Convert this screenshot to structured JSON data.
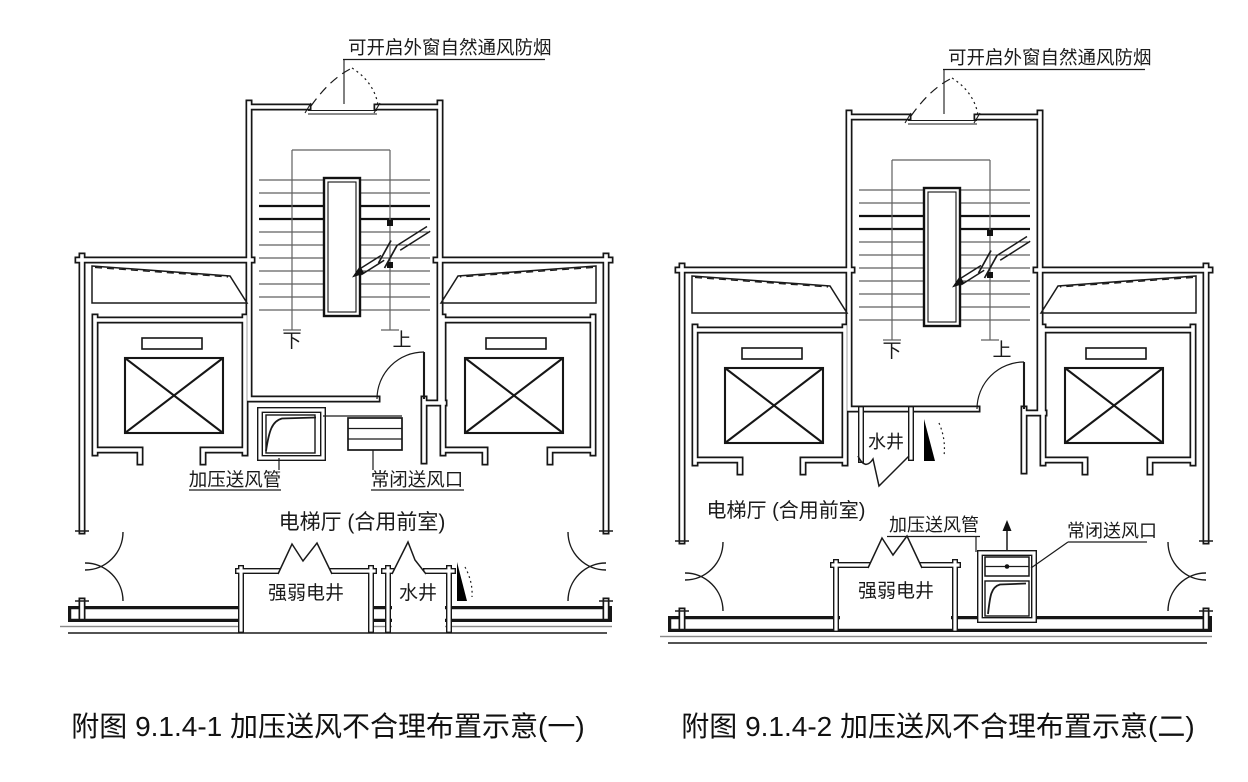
{
  "figure": {
    "window_label": "可开启外窗自然通风防烟",
    "stair_down": "下",
    "stair_up": "上",
    "duct_label": "加压送风管",
    "closed_outlet_label": "常闭送风口",
    "hall_label": "电梯厅 (合用前室)",
    "electrical_shaft_label": "强弱电井",
    "water_shaft_label": "水井",
    "caption_1": "附图 9.1.4-1 加压送风不合理布置示意(一)",
    "caption_2": "附图 9.1.4-2 加压送风不合理布置示意(二)",
    "colors": {
      "line": "#1a1a1a",
      "background": "#ffffff"
    }
  }
}
